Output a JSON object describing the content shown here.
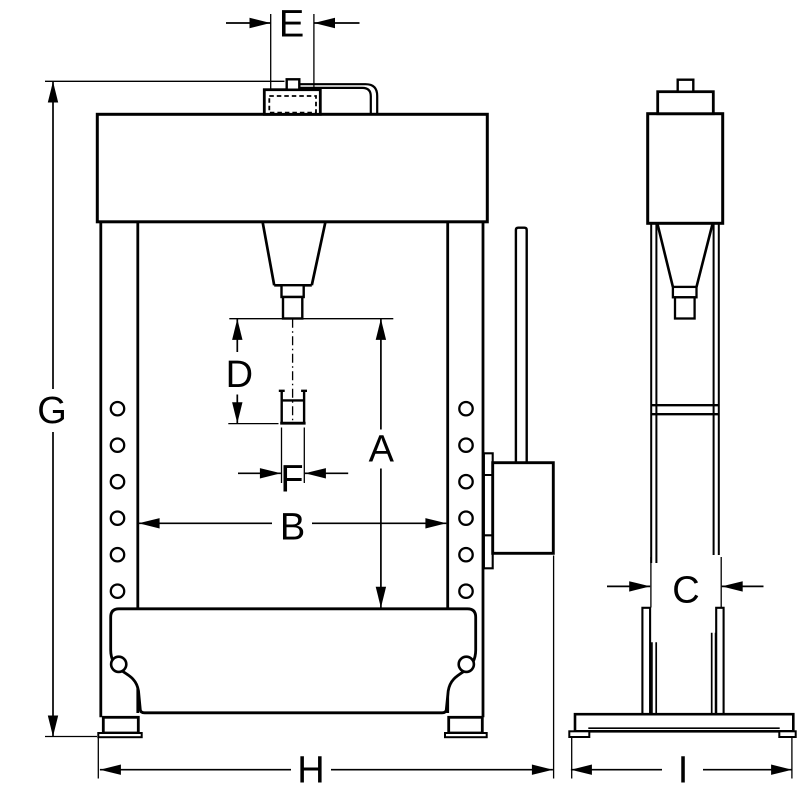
{
  "drawing": {
    "type": "technical-dimension-drawing",
    "views": 2
  },
  "colors": {
    "line": "#000000",
    "background": "#ffffff"
  },
  "dims": {
    "A": "A",
    "B": "B",
    "C": "C",
    "D": "D",
    "E": "E",
    "F": "F",
    "G": "G",
    "H": "H",
    "I": "I"
  }
}
